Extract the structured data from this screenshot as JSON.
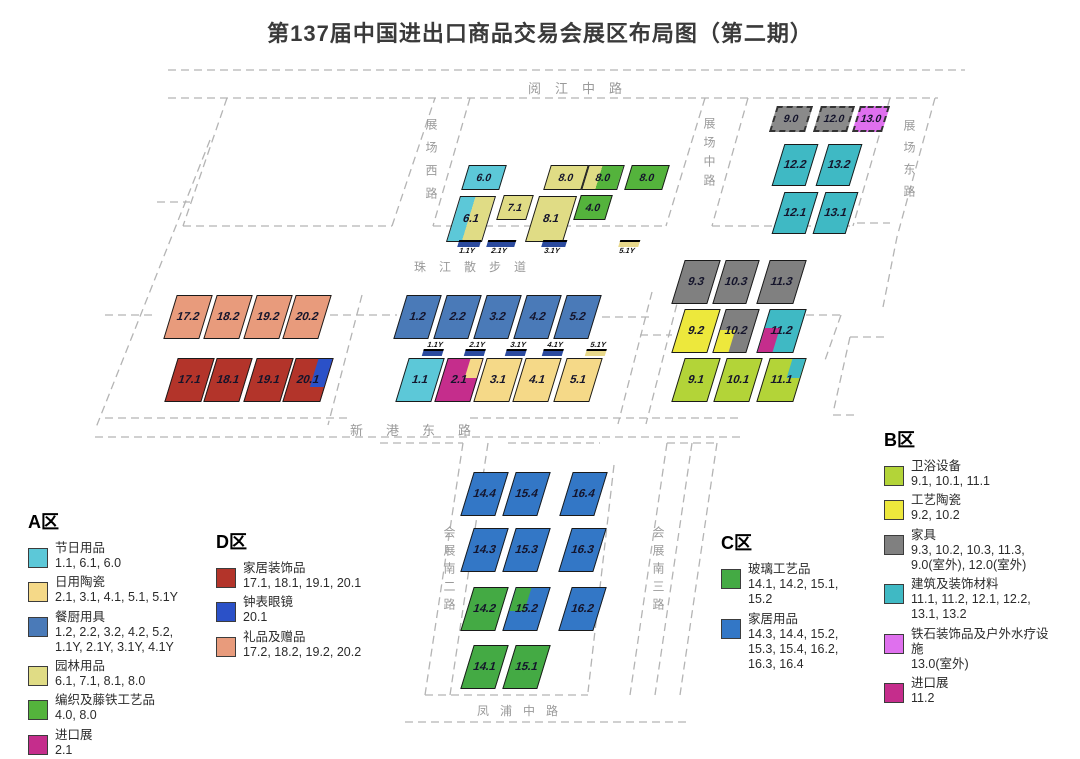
{
  "title": "第137届中国进出口商品交易会展区布局图（第二期）",
  "colors": {
    "festival_cyan": "#5cc8d8",
    "daily_ceramics_gold": "#f5d988",
    "kitchen_steelblue": "#4a7ab8",
    "garden_paleyellow": "#e0dc85",
    "weaving_green": "#54b33c",
    "import_magenta": "#c52d8c",
    "home_decor_darkred": "#b3342a",
    "gifts_salmon": "#e89b7c",
    "watch_blue": "#2b51c8",
    "glass_green": "#44aa44",
    "household_blue": "#3377c6",
    "sanitary_yellowgreen": "#b3d438",
    "art_ceramics_yellow": "#ede83c",
    "furniture_gray": "#808080",
    "building_teal": "#3fb9c4",
    "spa_violet": "#df70ee",
    "marker_navy": "#2b4a9e",
    "marker_gold": "#e8d88a",
    "dash_gray": "#b4b4b4",
    "road_text_gray": "#9a9a9a"
  },
  "halls": [
    {
      "id": "6.0",
      "x": 484,
      "y": 177,
      "w": 38,
      "h": 25,
      "fill": "#5cc8d8",
      "small": true
    },
    {
      "id": "8.0",
      "nid": "8.0a",
      "x": 566,
      "y": 177,
      "w": 38,
      "h": 25,
      "fill": "#e0dc85",
      "small": true
    },
    {
      "id": "8.0",
      "nid": "8.0b",
      "x": 603,
      "y": 177,
      "w": 36,
      "h": 25,
      "fill": "#e0dc85",
      "fill2": "#54b33c",
      "split": 38,
      "small": true
    },
    {
      "id": "8.0",
      "nid": "8.0c",
      "x": 647,
      "y": 177,
      "w": 38,
      "h": 25,
      "fill": "#54b33c",
      "small": true
    },
    {
      "id": "6.1",
      "x": 471,
      "y": 219,
      "w": 36,
      "h": 46,
      "fill": "#5cc8d8",
      "fill2": "#e0dc85",
      "split": 43
    },
    {
      "id": "7.1",
      "x": 515,
      "y": 207,
      "w": 30,
      "h": 25,
      "fill": "#e0dc85",
      "small": true
    },
    {
      "id": "8.1",
      "x": 551,
      "y": 219,
      "w": 38,
      "h": 46,
      "fill": "#e0dc85"
    },
    {
      "id": "4.0",
      "x": 593,
      "y": 207,
      "w": 32,
      "h": 25,
      "fill": "#54b33c",
      "small": true
    },
    {
      "id": "1.2",
      "x": 417,
      "y": 317,
      "w": 35,
      "h": 44,
      "fill": "#4a7ab8"
    },
    {
      "id": "2.2",
      "x": 457,
      "y": 317,
      "w": 35,
      "h": 44,
      "fill": "#4a7ab8"
    },
    {
      "id": "3.2",
      "x": 497,
      "y": 317,
      "w": 35,
      "h": 44,
      "fill": "#4a7ab8"
    },
    {
      "id": "4.2",
      "x": 537,
      "y": 317,
      "w": 35,
      "h": 44,
      "fill": "#4a7ab8"
    },
    {
      "id": "5.2",
      "x": 577,
      "y": 317,
      "w": 35,
      "h": 44,
      "fill": "#4a7ab8"
    },
    {
      "id": "1.1",
      "x": 420,
      "y": 380,
      "w": 36,
      "h": 44,
      "fill": "#5cc8d8"
    },
    {
      "id": "2.1",
      "x": 459,
      "y": 380,
      "w": 36,
      "h": 44,
      "fill": "#c52d8c",
      "overlay": {
        "pos": "tr",
        "w": 36,
        "h": 46,
        "color": "#f5d988"
      }
    },
    {
      "id": "3.1",
      "x": 498,
      "y": 380,
      "w": 36,
      "h": 44,
      "fill": "#f5d988"
    },
    {
      "id": "4.1",
      "x": 537,
      "y": 380,
      "w": 36,
      "h": 44,
      "fill": "#f5d988"
    },
    {
      "id": "5.1",
      "x": 578,
      "y": 380,
      "w": 36,
      "h": 44,
      "fill": "#f5d988"
    },
    {
      "id": "17.2",
      "x": 188,
      "y": 317,
      "w": 36,
      "h": 44,
      "fill": "#e89b7c"
    },
    {
      "id": "18.2",
      "x": 228,
      "y": 317,
      "w": 36,
      "h": 44,
      "fill": "#e89b7c"
    },
    {
      "id": "19.2",
      "x": 268,
      "y": 317,
      "w": 36,
      "h": 44,
      "fill": "#e89b7c"
    },
    {
      "id": "20.2",
      "x": 307,
      "y": 317,
      "w": 36,
      "h": 44,
      "fill": "#e89b7c"
    },
    {
      "id": "17.1",
      "x": 189,
      "y": 380,
      "w": 37,
      "h": 44,
      "fill": "#b3342a"
    },
    {
      "id": "18.1",
      "x": 228,
      "y": 380,
      "w": 36,
      "h": 44,
      "fill": "#b3342a"
    },
    {
      "id": "19.1",
      "x": 268,
      "y": 380,
      "w": 37,
      "h": 44,
      "fill": "#b3342a"
    },
    {
      "id": "20.1",
      "x": 308,
      "y": 380,
      "w": 38,
      "h": 44,
      "fill": "#b3342a",
      "overlay": {
        "pos": "tr",
        "w": 40,
        "h": 66,
        "color": "#2b51c8"
      }
    },
    {
      "id": "9.0",
      "x": 791,
      "y": 119,
      "w": 36,
      "h": 26,
      "fill": "#8a8a8a",
      "dashed": true,
      "small": true
    },
    {
      "id": "12.0",
      "x": 834,
      "y": 119,
      "w": 34,
      "h": 26,
      "fill": "#8a8a8a",
      "dashed": true,
      "small": true
    },
    {
      "id": "13.0",
      "x": 871,
      "y": 119,
      "w": 30,
      "h": 26,
      "fill": "#df70ee",
      "dashed": true,
      "small": true
    },
    {
      "id": "12.2",
      "x": 795,
      "y": 165,
      "w": 34,
      "h": 42,
      "fill": "#3fb9c4"
    },
    {
      "id": "13.2",
      "x": 839,
      "y": 165,
      "w": 34,
      "h": 42,
      "fill": "#3fb9c4"
    },
    {
      "id": "12.1",
      "x": 795,
      "y": 213,
      "w": 34,
      "h": 42,
      "fill": "#3fb9c4"
    },
    {
      "id": "13.1",
      "x": 835,
      "y": 213,
      "w": 33,
      "h": 42,
      "fill": "#3fb9c4"
    },
    {
      "id": "9.3",
      "x": 696,
      "y": 282,
      "w": 36,
      "h": 44,
      "fill": "#808080"
    },
    {
      "id": "10.3",
      "x": 736,
      "y": 282,
      "w": 34,
      "h": 44,
      "fill": "#808080"
    },
    {
      "id": "11.3",
      "x": 781,
      "y": 282,
      "w": 37,
      "h": 44,
      "fill": "#808080"
    },
    {
      "id": "9.2",
      "x": 696,
      "y": 331,
      "w": 36,
      "h": 44,
      "fill": "#ede83c"
    },
    {
      "id": "10.2",
      "x": 736,
      "y": 331,
      "w": 34,
      "h": 44,
      "fill": "#808080",
      "overlay": {
        "pos": "bl",
        "w": 46,
        "h": 52,
        "color": "#ede83c"
      }
    },
    {
      "id": "11.2",
      "x": 781,
      "y": 331,
      "w": 37,
      "h": 44,
      "fill": "#3fb9c4",
      "overlay": {
        "pos": "bl",
        "w": 42,
        "h": 56,
        "color": "#c52d8c"
      }
    },
    {
      "id": "9.1",
      "x": 696,
      "y": 380,
      "w": 36,
      "h": 44,
      "fill": "#b3d438"
    },
    {
      "id": "10.1",
      "x": 738,
      "y": 380,
      "w": 36,
      "h": 44,
      "fill": "#b3d438"
    },
    {
      "id": "11.1",
      "x": 781,
      "y": 380,
      "w": 37,
      "h": 44,
      "fill": "#b3d438",
      "overlay": {
        "pos": "tr",
        "w": 36,
        "h": 46,
        "color": "#3fb9c4"
      }
    },
    {
      "id": "14.4",
      "x": 484,
      "y": 494,
      "w": 35,
      "h": 44,
      "fill": "#3377c6"
    },
    {
      "id": "15.4",
      "x": 526,
      "y": 494,
      "w": 35,
      "h": 44,
      "fill": "#3377c6"
    },
    {
      "id": "16.4",
      "x": 583,
      "y": 494,
      "w": 35,
      "h": 44,
      "fill": "#3377c6"
    },
    {
      "id": "14.3",
      "x": 484,
      "y": 550,
      "w": 35,
      "h": 44,
      "fill": "#3377c6"
    },
    {
      "id": "15.3",
      "x": 526,
      "y": 550,
      "w": 35,
      "h": 44,
      "fill": "#3377c6"
    },
    {
      "id": "16.3",
      "x": 582,
      "y": 550,
      "w": 35,
      "h": 44,
      "fill": "#3377c6"
    },
    {
      "id": "14.2",
      "x": 484,
      "y": 609,
      "w": 35,
      "h": 44,
      "fill": "#44aa44"
    },
    {
      "id": "15.2",
      "x": 526,
      "y": 609,
      "w": 35,
      "h": 44,
      "fill": "#3377c6",
      "overlay": {
        "pos": "tl",
        "w": 46,
        "h": 54,
        "color": "#44aa44"
      }
    },
    {
      "id": "16.2",
      "x": 582,
      "y": 609,
      "w": 35,
      "h": 44,
      "fill": "#3377c6"
    },
    {
      "id": "14.1",
      "x": 484,
      "y": 667,
      "w": 35,
      "h": 44,
      "fill": "#44aa44"
    },
    {
      "id": "15.1",
      "x": 526,
      "y": 667,
      "w": 35,
      "h": 44,
      "fill": "#44aa44"
    }
  ],
  "markers": [
    {
      "id": "1.1Y",
      "row": "top",
      "x": 468,
      "y": 240,
      "w": 22,
      "color": "#2b4a9e",
      "labelPos": "below"
    },
    {
      "id": "2.1Y",
      "row": "top",
      "x": 500,
      "y": 240,
      "w": 28,
      "color": "#2b4a9e",
      "labelPos": "below"
    },
    {
      "id": "3.1Y",
      "row": "top",
      "x": 553,
      "y": 240,
      "w": 24,
      "color": "#2b4a9e",
      "labelPos": "below"
    },
    {
      "id": "5.1Y",
      "row": "top",
      "x": 628,
      "y": 240,
      "w": 20,
      "color": "#e8d88a",
      "labelPos": "below"
    },
    {
      "id": "1.1Y",
      "row": "mid",
      "x": 434,
      "y": 341,
      "w": 20,
      "color": "#2b4a9e",
      "labelPos": "above"
    },
    {
      "id": "2.1Y",
      "row": "mid",
      "x": 476,
      "y": 341,
      "w": 20,
      "color": "#2b4a9e",
      "labelPos": "above"
    },
    {
      "id": "3.1Y",
      "row": "mid",
      "x": 517,
      "y": 341,
      "w": 20,
      "color": "#2b4a9e",
      "labelPos": "above"
    },
    {
      "id": "4.1Y",
      "row": "mid",
      "x": 554,
      "y": 341,
      "w": 20,
      "color": "#2b4a9e",
      "labelPos": "above"
    },
    {
      "id": "5.1Y",
      "row": "mid",
      "x": 597,
      "y": 341,
      "w": 20,
      "color": "#e8d88a",
      "labelPos": "above"
    }
  ],
  "roads": [
    {
      "id": "yuejiang-zhong-lu",
      "text": "阅江中路",
      "x": 528,
      "y": 78,
      "fs": 13,
      "ls": 14,
      "v": false
    },
    {
      "id": "zhanchang-xi-lu",
      "text": "展场西路",
      "x": 423,
      "y": 118,
      "fs": 12,
      "ls": 11,
      "v": true
    },
    {
      "id": "zhanchang-zhong-lu",
      "text": "展场中路",
      "x": 701,
      "y": 117,
      "fs": 12,
      "ls": 7,
      "v": true
    },
    {
      "id": "zhanchang-dong-lu",
      "text": "展场东路",
      "x": 901,
      "y": 119,
      "fs": 12,
      "ls": 10,
      "v": true
    },
    {
      "id": "zhujiang-sanbudao",
      "text": "珠江散步道",
      "x": 414,
      "y": 258,
      "fs": 12,
      "ls": 13,
      "v": false
    },
    {
      "id": "xingang-dong-lu",
      "text": "新港东路",
      "x": 350,
      "y": 420,
      "fs": 13,
      "ls": 23,
      "v": false
    },
    {
      "id": "huizhan-nan-er-lu",
      "text": "会展南二路",
      "x": 441,
      "y": 526,
      "fs": 12,
      "ls": 6,
      "v": true
    },
    {
      "id": "huizhan-nan-san-lu",
      "text": "会展南三路",
      "x": 650,
      "y": 526,
      "fs": 12,
      "ls": 6,
      "v": true
    },
    {
      "id": "fengpu-zhong-lu",
      "text": "凤浦中路",
      "x": 477,
      "y": 702,
      "fs": 12,
      "ls": 11,
      "v": false
    }
  ],
  "legends": [
    {
      "id": "A",
      "title": "A区",
      "x": 28,
      "y": 508,
      "w": 185,
      "items": [
        {
          "color": "#5cc8d8",
          "name": "节日用品",
          "codes": "1.1, 6.1, 6.0"
        },
        {
          "color": "#f5d988",
          "name": "日用陶瓷",
          "codes": "2.1, 3.1, 4.1, 5.1, 5.1Y"
        },
        {
          "color": "#4a7ab8",
          "name": "餐厨用具",
          "codes": "1.2, 2.2, 3.2, 4.2, 5.2,\n1.1Y, 2.1Y, 3.1Y, 4.1Y"
        },
        {
          "color": "#e0dc85",
          "name": "园林用品",
          "codes": "6.1, 7.1, 8.1, 8.0"
        },
        {
          "color": "#54b33c",
          "name": "编织及藤铁工艺品",
          "codes": "4.0, 8.0"
        },
        {
          "color": "#c52d8c",
          "name": "进口展",
          "codes": "2.1"
        }
      ]
    },
    {
      "id": "D",
      "title": "D区",
      "x": 216,
      "y": 528,
      "w": 175,
      "items": [
        {
          "color": "#b3342a",
          "name": "家居装饰品",
          "codes": "17.1, 18.1, 19.1, 20.1"
        },
        {
          "color": "#2b51c8",
          "name": "钟表眼镜",
          "codes": "20.1"
        },
        {
          "color": "#e89b7c",
          "name": "礼品及赠品",
          "codes": "17.2, 18.2, 19.2, 20.2"
        }
      ]
    },
    {
      "id": "C",
      "title": "C区",
      "x": 721,
      "y": 529,
      "w": 150,
      "items": [
        {
          "color": "#44aa44",
          "name": "玻璃工艺品",
          "codes": "14.1, 14.2, 15.1,\n15.2"
        },
        {
          "color": "#3377c6",
          "name": "家居用品",
          "codes": "14.3, 14.4, 15.2,\n15.3, 15.4, 16.2,\n16.3, 16.4"
        }
      ]
    },
    {
      "id": "B",
      "title": "B区",
      "x": 884,
      "y": 426,
      "w": 170,
      "items": [
        {
          "color": "#b3d438",
          "name": "卫浴设备",
          "codes": "9.1, 10.1, 11.1"
        },
        {
          "color": "#ede83c",
          "name": "工艺陶瓷",
          "codes": "9.2, 10.2"
        },
        {
          "color": "#808080",
          "name": "家具",
          "codes": "9.3, 10.2, 10.3, 11.3,\n9.0(室外), 12.0(室外)"
        },
        {
          "color": "#3fb9c4",
          "name": "建筑及装饰材料",
          "codes": "11.1, 11.2, 12.1, 12.2,\n13.1, 13.2"
        },
        {
          "color": "#df70ee",
          "name": "铁石装饰品及户外水疗设施",
          "codes": "13.0(室外)"
        },
        {
          "color": "#c52d8c",
          "name": "进口展",
          "codes": "11.2"
        }
      ]
    }
  ]
}
